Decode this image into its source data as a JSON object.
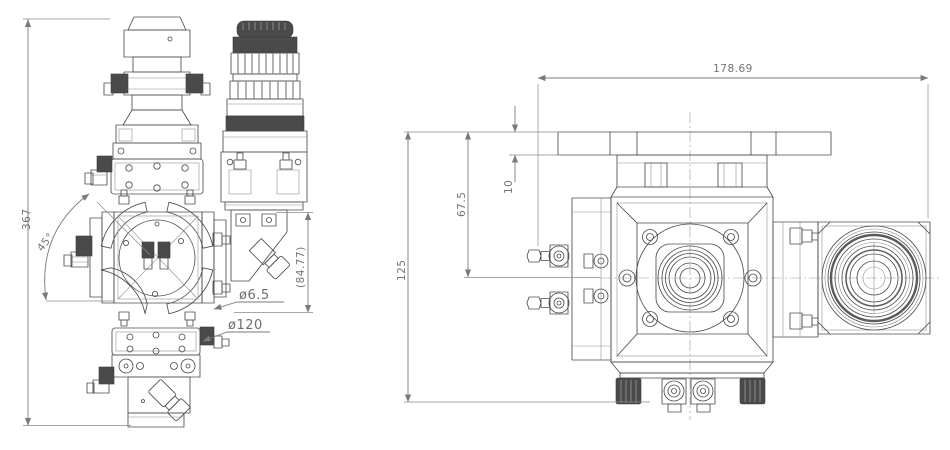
{
  "drawing": {
    "background": "#ffffff",
    "line_color": "#4d4d4d",
    "dim_color": "#7a7a7a",
    "front_view": {
      "dims": {
        "overall_height": "367",
        "rotation_angle": "45°",
        "hole_dia": "ø6.5",
        "bolt_circle": "ø120",
        "ref_height": "(84.77)"
      }
    },
    "top_view": {
      "dims": {
        "overall_width": "178.69",
        "flange_thickness": "10",
        "flange_to_axis": "67.5",
        "flange_to_bottom": "125"
      }
    }
  }
}
